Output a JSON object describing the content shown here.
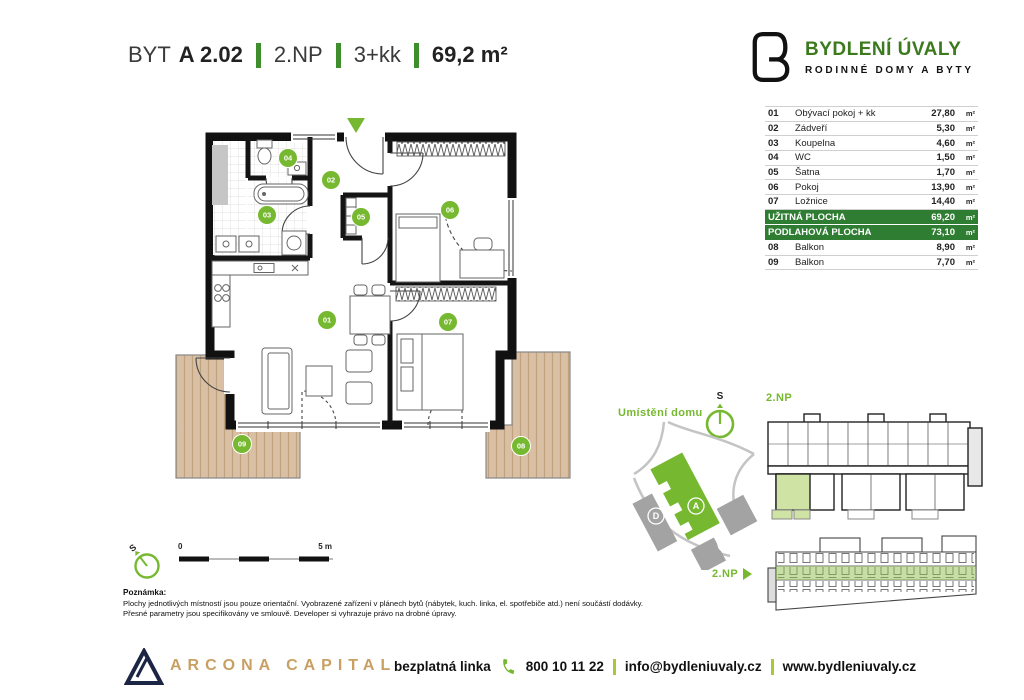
{
  "title": {
    "prefix": "BYT",
    "unit": "A 2.02",
    "floor": "2.NP",
    "disposition": "3+kk",
    "area": "69,2 m²"
  },
  "brand": {
    "name": "BYDLENÍ ÚVALY",
    "tagline": "RODINNÉ DOMY A BYTY"
  },
  "table": {
    "rooms": [
      {
        "num": "01",
        "name": "Obývací pokoj + kk",
        "area": "27,80",
        "unit": "m²"
      },
      {
        "num": "02",
        "name": "Zádveří",
        "area": "5,30",
        "unit": "m²"
      },
      {
        "num": "03",
        "name": "Koupelna",
        "area": "4,60",
        "unit": "m²"
      },
      {
        "num": "04",
        "name": "WC",
        "area": "1,50",
        "unit": "m²"
      },
      {
        "num": "05",
        "name": "Šatna",
        "area": "1,70",
        "unit": "m²"
      },
      {
        "num": "06",
        "name": "Pokoj",
        "area": "13,90",
        "unit": "m²"
      },
      {
        "num": "07",
        "name": "Ložnice",
        "area": "14,40",
        "unit": "m²"
      }
    ],
    "totals": [
      {
        "label": "UŽITNÁ PLOCHA",
        "area": "69,20",
        "unit": "m²"
      },
      {
        "label": "PODLAHOVÁ PLOCHA",
        "area": "73,10",
        "unit": "m²"
      }
    ],
    "extras": [
      {
        "num": "08",
        "name": "Balkon",
        "area": "8,90",
        "unit": "m²"
      },
      {
        "num": "09",
        "name": "Balkon",
        "area": "7,70",
        "unit": "m²"
      }
    ]
  },
  "plan": {
    "badges": [
      {
        "num": "01",
        "x": 177,
        "y": 212
      },
      {
        "num": "02",
        "x": 181,
        "y": 72
      },
      {
        "num": "03",
        "x": 117,
        "y": 107
      },
      {
        "num": "04",
        "x": 138,
        "y": 50
      },
      {
        "num": "05",
        "x": 211,
        "y": 109
      },
      {
        "num": "06",
        "x": 300,
        "y": 102
      },
      {
        "num": "07",
        "x": 298,
        "y": 214
      },
      {
        "num": "08",
        "x": 371,
        "y": 338
      },
      {
        "num": "09",
        "x": 92,
        "y": 336
      }
    ]
  },
  "site": {
    "label": "Umístění domu",
    "compass": "S",
    "buildings": [
      {
        "letter": "A",
        "x": 84,
        "y": 86
      },
      {
        "letter": "B",
        "x": 114,
        "y": 124
      },
      {
        "letter": "C",
        "x": 72,
        "y": 144
      },
      {
        "letter": "D",
        "x": 44,
        "y": 96
      }
    ]
  },
  "overview": {
    "label": "2.NP"
  },
  "elevation": {
    "label": "2.NP"
  },
  "scalebar": {
    "start": "0",
    "end": "5 m",
    "compass": "S"
  },
  "note": {
    "heading": "Poznámka:",
    "line1": "Plochy jednotlivých místností jsou pouze orientační. Vyobrazené zařízení v plánech bytů (nábytek, kuch. linka, el. spotřebiče atd.) není součástí dodávky.",
    "line2": "Přesné parametry jsou specifikovány ve smlouvě. Developer si vyhrazuje právo na drobné úpravy."
  },
  "footer": {
    "brand": "ARCONA CAPITAL",
    "phone_label": "bezplatná linka",
    "phone": "800 10 11 22",
    "email": "info@bydleniuvaly.cz",
    "website": "www.bydleniuvaly.cz"
  },
  "colors": {
    "accent": "#76b82f",
    "dark_green": "#2e7d32",
    "separator_green": "#a9c837",
    "gold": "#c9a063",
    "navy": "#1d2545",
    "wood": "#d9bfa3"
  }
}
